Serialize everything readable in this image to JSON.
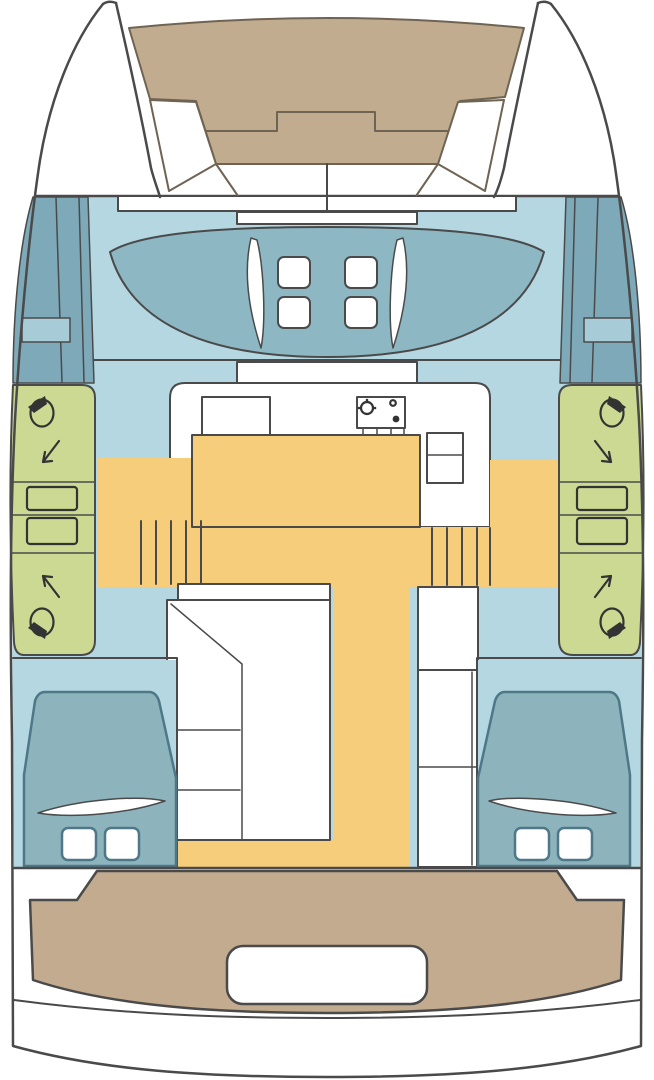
{
  "colors": {
    "white": "#ffffff",
    "deck_blue": "#b4d7e1",
    "side_deck_teal": "#7ea9b8",
    "cockpit_teal": "#8cb7c3",
    "hatch_blue": "#a8ccd7",
    "trampoline_tan": "#c2ac90",
    "aft_cockpit_tan": "#c2ab8e",
    "heads_green": "#cbd993",
    "floor_yellow": "#f5cd7b",
    "bed_teal": "#8db4bc",
    "outline_dark": "#4a4a4a"
  }
}
